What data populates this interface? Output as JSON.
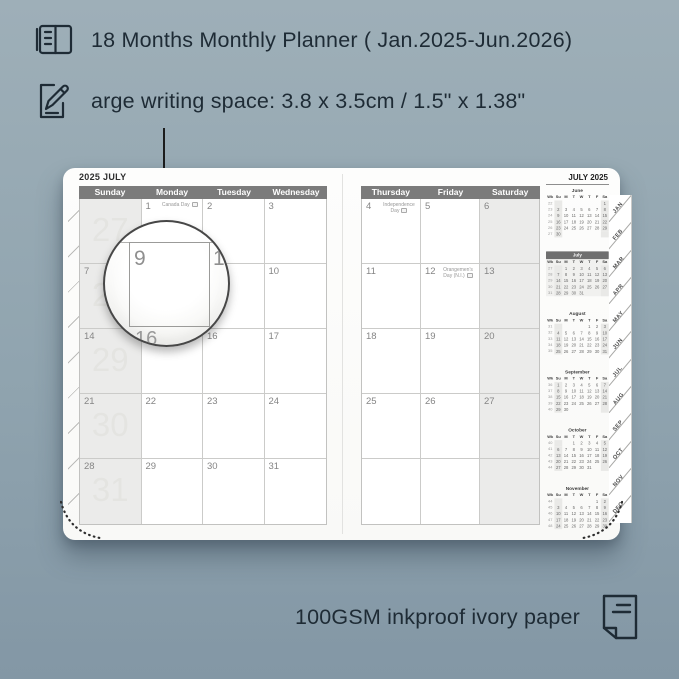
{
  "colors": {
    "background": "#90a4af",
    "ink": "#1e2b35",
    "header_bar": "#7b7b7b",
    "shaded_column": "#ebebea",
    "week_number": "#e4e4e1",
    "current_month_bar": "#6f6f6f"
  },
  "features": [
    {
      "icon": "planner-book-icon",
      "text": "18 Months Monthly Planner ( Jan.2025-Jun.2026)"
    },
    {
      "icon": "writing-space-icon",
      "text": "arge writing space: 3.8 x 3.5cm / 1.5\" x 1.38\""
    }
  ],
  "footer": {
    "icon": "ivory-paper-icon",
    "text": "100GSM inkproof ivory paper"
  },
  "planner": {
    "left_page": {
      "title": "2025 JULY",
      "day_headers": [
        "Sunday",
        "Monday",
        "Tuesday",
        "Wednesday"
      ],
      "shaded_column_index": 0,
      "rows": [
        {
          "week_number": "27",
          "cells": [
            {
              "date": ""
            },
            {
              "date": "1",
              "holiday": "Canada Day"
            },
            {
              "date": "2"
            },
            {
              "date": "3"
            }
          ]
        },
        {
          "week_number": "28",
          "cells": [
            {
              "date": "7"
            },
            {
              "date": "8"
            },
            {
              "date": "9"
            },
            {
              "date": "10"
            }
          ]
        },
        {
          "week_number": "29",
          "cells": [
            {
              "date": "14"
            },
            {
              "date": "15"
            },
            {
              "date": "16"
            },
            {
              "date": "17"
            }
          ]
        },
        {
          "week_number": "30",
          "cells": [
            {
              "date": "21"
            },
            {
              "date": "22"
            },
            {
              "date": "23"
            },
            {
              "date": "24"
            }
          ]
        },
        {
          "week_number": "31",
          "cells": [
            {
              "date": "28"
            },
            {
              "date": "29"
            },
            {
              "date": "30"
            },
            {
              "date": "31"
            }
          ]
        }
      ]
    },
    "right_page": {
      "day_headers": [
        "Thursday",
        "Friday",
        "Saturday"
      ],
      "shaded_column_index": 2,
      "rows": [
        {
          "cells": [
            {
              "date": "4",
              "holiday": "Independence Day"
            },
            {
              "date": "5"
            },
            {
              "date": "6"
            }
          ]
        },
        {
          "cells": [
            {
              "date": "11"
            },
            {
              "date": "12",
              "holiday": "Orangemen's Day (N.I.)"
            },
            {
              "date": "13"
            }
          ]
        },
        {
          "cells": [
            {
              "date": "18"
            },
            {
              "date": "19"
            },
            {
              "date": "20"
            }
          ]
        },
        {
          "cells": [
            {
              "date": "25"
            },
            {
              "date": "26"
            },
            {
              "date": "27"
            }
          ]
        },
        {
          "cells": [
            {
              "date": ""
            },
            {
              "date": ""
            },
            {
              "date": ""
            }
          ]
        }
      ]
    },
    "sidebar": {
      "title": "JULY 2025",
      "mini_header": [
        "Wk",
        "Su",
        "M",
        "T",
        "W",
        "T",
        "F",
        "Sa"
      ],
      "months": [
        {
          "name": "June",
          "current": false,
          "weeks": [
            {
              "wk": "22",
              "days": [
                "",
                "",
                "",
                "",
                "",
                "",
                "1"
              ]
            },
            {
              "wk": "23",
              "days": [
                "2",
                "3",
                "4",
                "5",
                "6",
                "7",
                "8"
              ]
            },
            {
              "wk": "24",
              "days": [
                "9",
                "10",
                "11",
                "12",
                "13",
                "14",
                "15"
              ]
            },
            {
              "wk": "25",
              "days": [
                "16",
                "17",
                "18",
                "19",
                "20",
                "21",
                "22"
              ]
            },
            {
              "wk": "26",
              "days": [
                "23",
                "24",
                "25",
                "26",
                "27",
                "28",
                "29"
              ]
            },
            {
              "wk": "27",
              "days": [
                "30",
                "",
                "",
                "",
                "",
                "",
                ""
              ]
            }
          ]
        },
        {
          "name": "July",
          "current": true,
          "weeks": [
            {
              "wk": "27",
              "days": [
                "",
                "1",
                "2",
                "3",
                "4",
                "5",
                "6"
              ]
            },
            {
              "wk": "28",
              "days": [
                "7",
                "8",
                "9",
                "10",
                "11",
                "12",
                "13"
              ]
            },
            {
              "wk": "29",
              "days": [
                "14",
                "15",
                "16",
                "17",
                "18",
                "19",
                "20"
              ]
            },
            {
              "wk": "30",
              "days": [
                "21",
                "22",
                "23",
                "24",
                "25",
                "26",
                "27"
              ]
            },
            {
              "wk": "31",
              "days": [
                "28",
                "29",
                "30",
                "31",
                "",
                "",
                ""
              ]
            }
          ]
        },
        {
          "name": "August",
          "current": false,
          "weeks": [
            {
              "wk": "31",
              "days": [
                "",
                "",
                "",
                "",
                "1",
                "2",
                "3"
              ]
            },
            {
              "wk": "32",
              "days": [
                "4",
                "5",
                "6",
                "7",
                "8",
                "9",
                "10"
              ]
            },
            {
              "wk": "33",
              "days": [
                "11",
                "12",
                "13",
                "14",
                "15",
                "16",
                "17"
              ]
            },
            {
              "wk": "34",
              "days": [
                "18",
                "19",
                "20",
                "21",
                "22",
                "23",
                "24"
              ]
            },
            {
              "wk": "35",
              "days": [
                "25",
                "26",
                "27",
                "28",
                "29",
                "30",
                "31"
              ]
            }
          ]
        },
        {
          "name": "September",
          "current": false,
          "weeks": [
            {
              "wk": "36",
              "days": [
                "1",
                "2",
                "3",
                "4",
                "5",
                "6",
                "7"
              ]
            },
            {
              "wk": "37",
              "days": [
                "8",
                "9",
                "10",
                "11",
                "12",
                "13",
                "14"
              ]
            },
            {
              "wk": "38",
              "days": [
                "15",
                "16",
                "17",
                "18",
                "19",
                "20",
                "21"
              ]
            },
            {
              "wk": "39",
              "days": [
                "22",
                "23",
                "24",
                "25",
                "26",
                "27",
                "28"
              ]
            },
            {
              "wk": "40",
              "days": [
                "29",
                "30",
                "",
                "",
                "",
                "",
                ""
              ]
            }
          ]
        },
        {
          "name": "October",
          "current": false,
          "weeks": [
            {
              "wk": "40",
              "days": [
                "",
                "",
                "1",
                "2",
                "3",
                "4",
                "5"
              ]
            },
            {
              "wk": "41",
              "days": [
                "6",
                "7",
                "8",
                "9",
                "10",
                "11",
                "12"
              ]
            },
            {
              "wk": "42",
              "days": [
                "13",
                "14",
                "15",
                "16",
                "17",
                "18",
                "19"
              ]
            },
            {
              "wk": "43",
              "days": [
                "20",
                "21",
                "22",
                "23",
                "24",
                "25",
                "26"
              ]
            },
            {
              "wk": "44",
              "days": [
                "27",
                "28",
                "29",
                "30",
                "31",
                "",
                ""
              ]
            }
          ]
        },
        {
          "name": "November",
          "current": false,
          "weeks": [
            {
              "wk": "44",
              "days": [
                "",
                "",
                "",
                "",
                "",
                "1",
                "2"
              ]
            },
            {
              "wk": "45",
              "days": [
                "3",
                "4",
                "5",
                "6",
                "7",
                "8",
                "9"
              ]
            },
            {
              "wk": "46",
              "days": [
                "10",
                "11",
                "12",
                "13",
                "14",
                "15",
                "16"
              ]
            },
            {
              "wk": "47",
              "days": [
                "17",
                "18",
                "19",
                "20",
                "21",
                "22",
                "23"
              ]
            },
            {
              "wk": "48",
              "days": [
                "24",
                "25",
                "26",
                "27",
                "28",
                "29",
                "30"
              ]
            }
          ]
        }
      ]
    },
    "month_tabs": [
      "JAN",
      "FEB",
      "MAR",
      "APR",
      "MAY",
      "JUN",
      "JUL",
      "AUG",
      "SEP",
      "OCT",
      "NOV",
      "DEC"
    ],
    "magnifier": {
      "cell_date": "9",
      "adjacent_right": "10",
      "adjacent_below": "16"
    }
  }
}
